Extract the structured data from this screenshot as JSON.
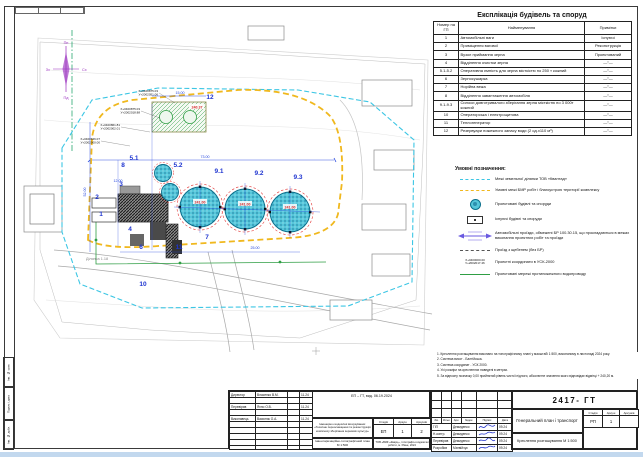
{
  "sheet": {
    "format_note": "Формат А2"
  },
  "plan": {
    "compass": {
      "n": "Пн",
      "s": "Пд",
      "w": "Зх",
      "e": "Сх"
    },
    "labels": [
      "1",
      "2",
      "3",
      "4",
      "5.1",
      "5.2",
      "6",
      "7",
      "8",
      "9.1",
      "9.2",
      "9.3",
      "10",
      "11",
      "12"
    ],
    "coords": [
      {
        "x": "Х+0400875.03",
        "y": "У+2002051.06"
      },
      {
        "x": "Х+0400875.03",
        "y": "У+2002018.88"
      },
      {
        "x": "Х+0400861.81",
        "y": "У+2002002.01"
      },
      {
        "x": "Х+0400846.07",
        "y": "У+2002000.00"
      }
    ],
    "dims": [
      "73.00",
      "15.00",
      "25.00",
      "52.00",
      "12.00"
    ],
    "elevations": [
      "240.37",
      "241.00",
      "241.00",
      "241.00"
    ],
    "area_label": "Ділянка 1.18"
  },
  "explication": {
    "title": "Експлікація будівель та споруд",
    "columns": {
      "num": "Номер на ГП",
      "name": "Найменування",
      "notes": "Примітки"
    },
    "rows": [
      {
        "num": "1",
        "name": "Автомобільні ваги",
        "notes": "Існуючі"
      },
      {
        "num": "2",
        "name": "Приміщення вагової",
        "notes": "Реконструкція"
      },
      {
        "num": "3",
        "name": "Вузол приймання зерна",
        "notes": "Проектований"
      },
      {
        "num": "4",
        "name": "Відділення очистки зерна",
        "notes": "—″—"
      },
      {
        "num": "5.1-5.2",
        "name": "Оперативна ємність для зерна місткістю по 250 т кожний",
        "notes": "—″—"
      },
      {
        "num": "6",
        "name": "Зерносушарка",
        "notes": "—″—"
      },
      {
        "num": "7",
        "name": "Норійна вежа",
        "notes": "—″—"
      },
      {
        "num": "8",
        "name": "Відділення завантаження автомобіля",
        "notes": "—″—"
      },
      {
        "num": "9.1-9.3",
        "name": "Силоси довготривалого зберігання зерна місткістю по 3 000т кожний",
        "notes": "—″—"
      },
      {
        "num": "10",
        "name": "Операторська і електрощитова",
        "notes": "—″—"
      },
      {
        "num": "11",
        "name": "Теплогенератор",
        "notes": "—″—"
      },
      {
        "num": "12",
        "name": "Резервуари пожежного запасу води (2 од.х110 м³)",
        "notes": "—″—"
      }
    ]
  },
  "legend": {
    "title": "Умовні позначення:",
    "items": [
      {
        "label": "Межі земельної ділянки ТОВ «Квантад»"
      },
      {
        "label": "Умовні межі БМР робіт і благоустрою території комплексу"
      },
      {
        "label": "Проектовані будівлі та споруди"
      },
      {
        "label": "Існуючі будівлі та споруди"
      },
      {
        "label": "Автомобільні проїзди, обмежені БР 100.30.15, що прокладаються в межах виконання проектних робіт та проїзди"
      },
      {
        "label": "Проїзд з щебенем (без БР)"
      },
      {
        "sym1": "Х+0400000.00",
        "sym2": "У+2002017.46",
        "label": "Проектні координати в УСК-2000"
      },
      {
        "label": "Проектовані мережі протипожежного водопроводу"
      }
    ]
  },
  "notes": {
    "lines": [
      "1. Креслення розташування виконано на топографічному плані у масштабі 1:500, виконаному в листопаді 2024 року.",
      "2. Система висот - Балтійська.",
      "3. Система координат - УСК 2000.",
      "4. Усі розміри на кресленнях наведені в метрах.",
      "5. За відносну позначку 0,00 прийнятий рівень чистої підлоги, абсолютне значення якого відповідає відмітці + 240,20 м."
    ]
  },
  "title_block_main": {
    "doc_number": "2417- ГТ",
    "header": [
      "Зм.",
      "Кільк.",
      "Арк.",
      "№док.",
      "Підпис",
      "Дата"
    ],
    "rows": [
      {
        "role": "ГІП",
        "name": "Демиденко",
        "date": "09.24"
      },
      {
        "role": "Н.контр.",
        "name": "Демиденко",
        "date": "09.24"
      },
      {
        "role": "Перевірив",
        "name": "Демиденко",
        "date": "09.24"
      },
      {
        "role": "Розробив",
        "name": "Матвійчук",
        "date": "09.24"
      }
    ],
    "title": "Генеральний план і транспорт",
    "subtitle": "Креслення розташування М 1:500",
    "stage_label": "Стадія",
    "sheet_label": "Аркуш",
    "sheets_label": "Аркушів",
    "stage": "РП",
    "sheet": "1",
    "sheets": ""
  },
  "title_block_survey": {
    "ref_note": "ЕП – ГТ, вид. 06.19.2024",
    "rows": [
      {
        "role": "Директор",
        "name": "Власенко В.М.",
        "date": "11.24"
      },
      {
        "role": "Перевірив",
        "name": "Яхно О.В.",
        "date": "11.24"
      },
      {
        "role": "Виконавець",
        "name": "Василюк О.А.",
        "date": "11.24"
      }
    ],
    "description": "Інженерно-геодезичні вишукування: «Технічне переоснащення та реконструкція комплексу зберігання зернових культур»",
    "subtitle": "Інвентаризаційно-топографічний план М 1:500",
    "stage_label": "Стадія",
    "sheet_label": "Аркуш",
    "sheets_label": "Аркушів",
    "stage": "ЕП",
    "sheet": "1",
    "sheets": "2",
    "company": "ТОВ «ВКФ «Кварц», топографо-геодезичні роботи, м. Рівне, 2024"
  },
  "side_stamp": {
    "labels": [
      "Інв. № ориг.",
      "Підпис і дата",
      "Інв. № дубл."
    ]
  }
}
